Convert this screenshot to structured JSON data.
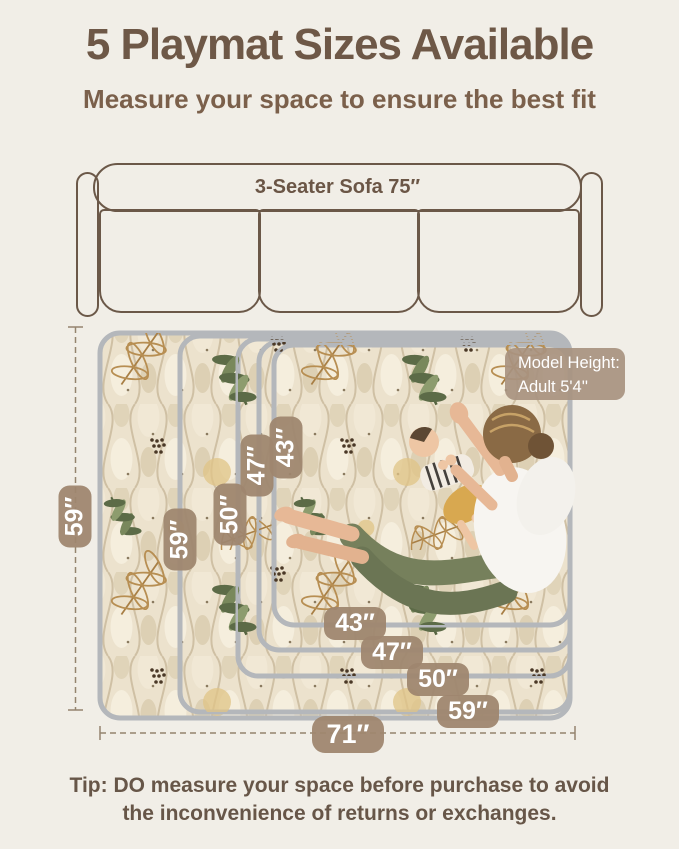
{
  "header": {
    "title": "5 Playmat Sizes Available",
    "subtitle": "Measure your space to ensure the best fit"
  },
  "sofa": {
    "label": "3-Seater Sofa 75″"
  },
  "model_badge": {
    "line1": "Model Height:",
    "line2": "Adult  5'4''"
  },
  "dims": {
    "left_outer": "59″",
    "bottom_outer": "71″",
    "vertical": [
      "59″",
      "50″",
      "47″",
      "43″"
    ],
    "horizontal": [
      "43″",
      "47″",
      "50″",
      "59″"
    ]
  },
  "tip": {
    "line1": "Tip: DO measure your space before purchase to avoid",
    "line2": "the inconvenience of returns or exchanges."
  },
  "colors": {
    "background": "#f1eee7",
    "title_text": "#6e5847",
    "badge": "#9e866f",
    "sofa_outline": "#6b5848",
    "mat_border": "#b4b7bb",
    "mat_base": "#ece2cd",
    "leaf_green": "#5c6b47",
    "leaf_tan": "#b78e52"
  }
}
